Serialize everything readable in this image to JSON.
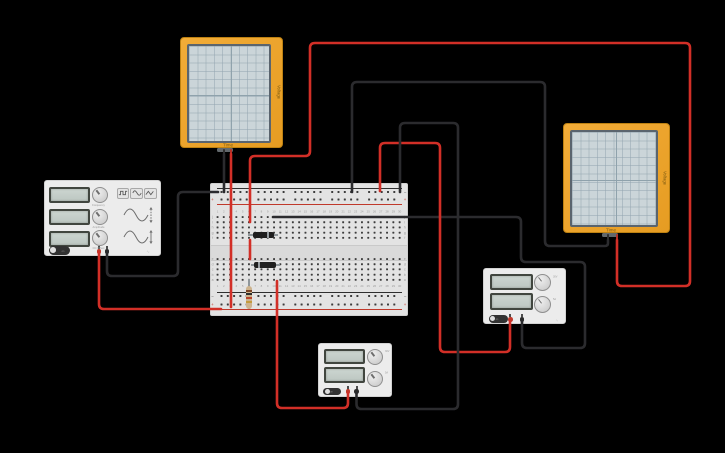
{
  "scene": {
    "width": 725,
    "height": 453,
    "background": "#000000"
  },
  "colors": {
    "wire_red": "#d22f27",
    "wire_black": "#2b2b2e",
    "osc_frame": "#eda62f",
    "osc_screen": "#ccd6da",
    "board": "#e3e3e3",
    "device_body": "#ececec",
    "display": "#c6cfca",
    "rail_red": "#c0392b",
    "rail_black": "#3a3a3a",
    "label_gray": "#9a9a9a"
  },
  "oscilloscope_left": {
    "time_label": "Time",
    "axis_label": "Voltage"
  },
  "oscilloscope_right": {
    "time_label": "Time",
    "axis_label": "Voltage"
  },
  "function_generator": {
    "displays": [
      "",
      "",
      ""
    ],
    "waveform_buttons": [
      "square-wave",
      "sine-wave",
      "triangle-wave"
    ],
    "knob_labels": [
      "Frequency",
      "Amplitude",
      "DC Offset"
    ],
    "power_label": "on",
    "brand_mark": "∿"
  },
  "power_supply_right": {
    "displays": [
      "",
      ""
    ],
    "knob_marks": [
      "30V",
      "5A"
    ],
    "power_label": "on",
    "brand_mark": "∿"
  },
  "power_supply_bottom": {
    "displays": [
      "",
      ""
    ],
    "knob_marks": [
      "30V",
      "5A"
    ],
    "power_label": "on",
    "brand_mark": "∿"
  },
  "breadboard": {
    "column_numbers": [
      "1",
      "2",
      "3",
      "4",
      "5",
      "6",
      "7",
      "8",
      "9",
      "10",
      "11",
      "12",
      "13",
      "14",
      "15",
      "16",
      "17",
      "18",
      "19",
      "20",
      "21",
      "22",
      "23",
      "24",
      "25",
      "26",
      "27",
      "28",
      "29",
      "30"
    ],
    "row_letters_top": [
      "j",
      "i",
      "h",
      "g",
      "f"
    ],
    "row_letters_bottom": [
      "e",
      "d",
      "c",
      "b",
      "a"
    ],
    "plus_symbol": "+",
    "minus_symbol": "−"
  },
  "components": {
    "diode_1": {
      "type": "diode",
      "orientation": "horizontal",
      "cathode_band": "right"
    },
    "diode_2": {
      "type": "diode",
      "orientation": "horizontal",
      "cathode_band": "left"
    },
    "resistor_1": {
      "type": "resistor",
      "orientation": "vertical",
      "band_colors": [
        "#7a4426",
        "#2d2d2d",
        "#b8452c",
        "#c49b3c"
      ]
    }
  },
  "wires": [
    {
      "name": "wire-fg-red-to-bottom-plus-rail",
      "color": "red",
      "points": [
        [
          99,
          252
        ],
        [
          99,
          309
        ],
        [
          221,
          309
        ]
      ]
    },
    {
      "name": "wire-fg-black-to-top-minus-rail",
      "color": "black",
      "points": [
        [
          107,
          252
        ],
        [
          107,
          276
        ],
        [
          178,
          276
        ],
        [
          178,
          192
        ],
        [
          218,
          192
        ]
      ]
    },
    {
      "name": "wire-osc-left-black-probe",
      "color": "black",
      "points": [
        [
          224,
          154
        ],
        [
          224,
          192
        ]
      ]
    },
    {
      "name": "wire-osc-left-red-probe",
      "color": "red",
      "points": [
        [
          231,
          154
        ],
        [
          231,
          307
        ]
      ]
    },
    {
      "name": "wire-osc-right-red-to-board",
      "color": "red",
      "points": [
        [
          617,
          240
        ],
        [
          617,
          286
        ],
        [
          690,
          286
        ],
        [
          690,
          43
        ],
        [
          310,
          43
        ],
        [
          310,
          156
        ],
        [
          250,
          156
        ],
        [
          250,
          222
        ]
      ]
    },
    {
      "name": "wire-red-gap-jumper",
      "color": "red",
      "points": [
        [
          250,
          240
        ],
        [
          250,
          259
        ]
      ]
    },
    {
      "name": "wire-osc-right-black-to-board",
      "color": "black",
      "points": [
        [
          608,
          240
        ],
        [
          608,
          246
        ],
        [
          545,
          246
        ],
        [
          545,
          82
        ],
        [
          352,
          82
        ],
        [
          352,
          192
        ]
      ]
    },
    {
      "name": "wire-board-to-psu-right-black",
      "color": "black",
      "points": [
        [
          273,
          217
        ],
        [
          521,
          217
        ],
        [
          521,
          262
        ],
        [
          585,
          262
        ],
        [
          585,
          348
        ],
        [
          522,
          348
        ],
        [
          522,
          321
        ]
      ]
    },
    {
      "name": "wire-rail-to-psu-right-red",
      "color": "red",
      "points": [
        [
          380,
          191
        ],
        [
          380,
          143
        ],
        [
          440,
          143
        ],
        [
          440,
          352
        ],
        [
          510,
          352
        ],
        [
          510,
          321
        ]
      ]
    },
    {
      "name": "wire-psu-bottom-black-to-rail",
      "color": "black",
      "points": [
        [
          356.5,
          393
        ],
        [
          356.5,
          409
        ],
        [
          458,
          409
        ],
        [
          458,
          123
        ],
        [
          400,
          123
        ],
        [
          400,
          192
        ]
      ]
    },
    {
      "name": "wire-psu-bottom-red-to-board",
      "color": "red",
      "points": [
        [
          348,
          393
        ],
        [
          348,
          408
        ],
        [
          277,
          408
        ],
        [
          277,
          281
        ]
      ]
    }
  ]
}
